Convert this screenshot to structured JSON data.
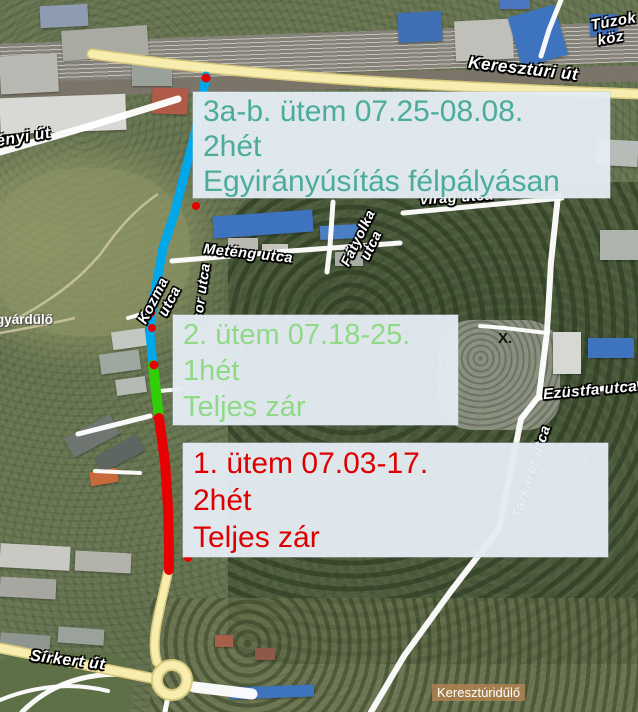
{
  "map": {
    "kind": "satellite-map-with-roadwork-annotations",
    "labels": {
      "kereszturi_ut": "Keresztúri út",
      "tuzok_line1": "Túzok",
      "tuzok_line2": "köz",
      "enyi_ut": "ényi út",
      "kozma_line1": "Kozma",
      "kozma_line2": "utca",
      "sor_utca": "sor utca",
      "meteng_utca": "Meténg utca",
      "fatyolka_line1": "Fátyolka",
      "fatyolka_line2": "utca",
      "virag_utca": "virág utca",
      "ezustfa_utca": "Ezüstfa utca",
      "tarkaret_utca": "Tarkarét utca",
      "x_district": "X.",
      "gyardulo": "gyárdűlő",
      "sirkert_ut": "Sírkert út",
      "kereszturidulo": "Keresztúridűlő"
    },
    "info_boxes": [
      {
        "id": "phase-3ab",
        "line1": "3a-b. ütem 07.25-08.08.",
        "line2": "2hét",
        "line3": "Egyirányúsítás félpályásan",
        "text_color": "#4bac9d",
        "route_color": "#00a7ea"
      },
      {
        "id": "phase-2",
        "line1": "2. ütem 07.18-25.",
        "line2": "1hét",
        "line3": "Teljes zár",
        "text_color": "#8fd987",
        "route_color": "#2fce06"
      },
      {
        "id": "phase-1",
        "line1": "1. ütem 07.03-17.",
        "line2": "2hét",
        "line3": "Teljes zár",
        "text_color": "#de0000",
        "route_color": "#e60202"
      }
    ],
    "colors": {
      "route_phase3_one_way": "#00a7ea",
      "route_phase2_full_closure": "#2fce06",
      "route_phase1_full_closure": "#e60202",
      "route_marker_dot": "#e60202",
      "main_road_yellow": "#f6edaf",
      "minor_road_white": "#ffffff",
      "info_box_background": "#e4ecf3"
    }
  }
}
